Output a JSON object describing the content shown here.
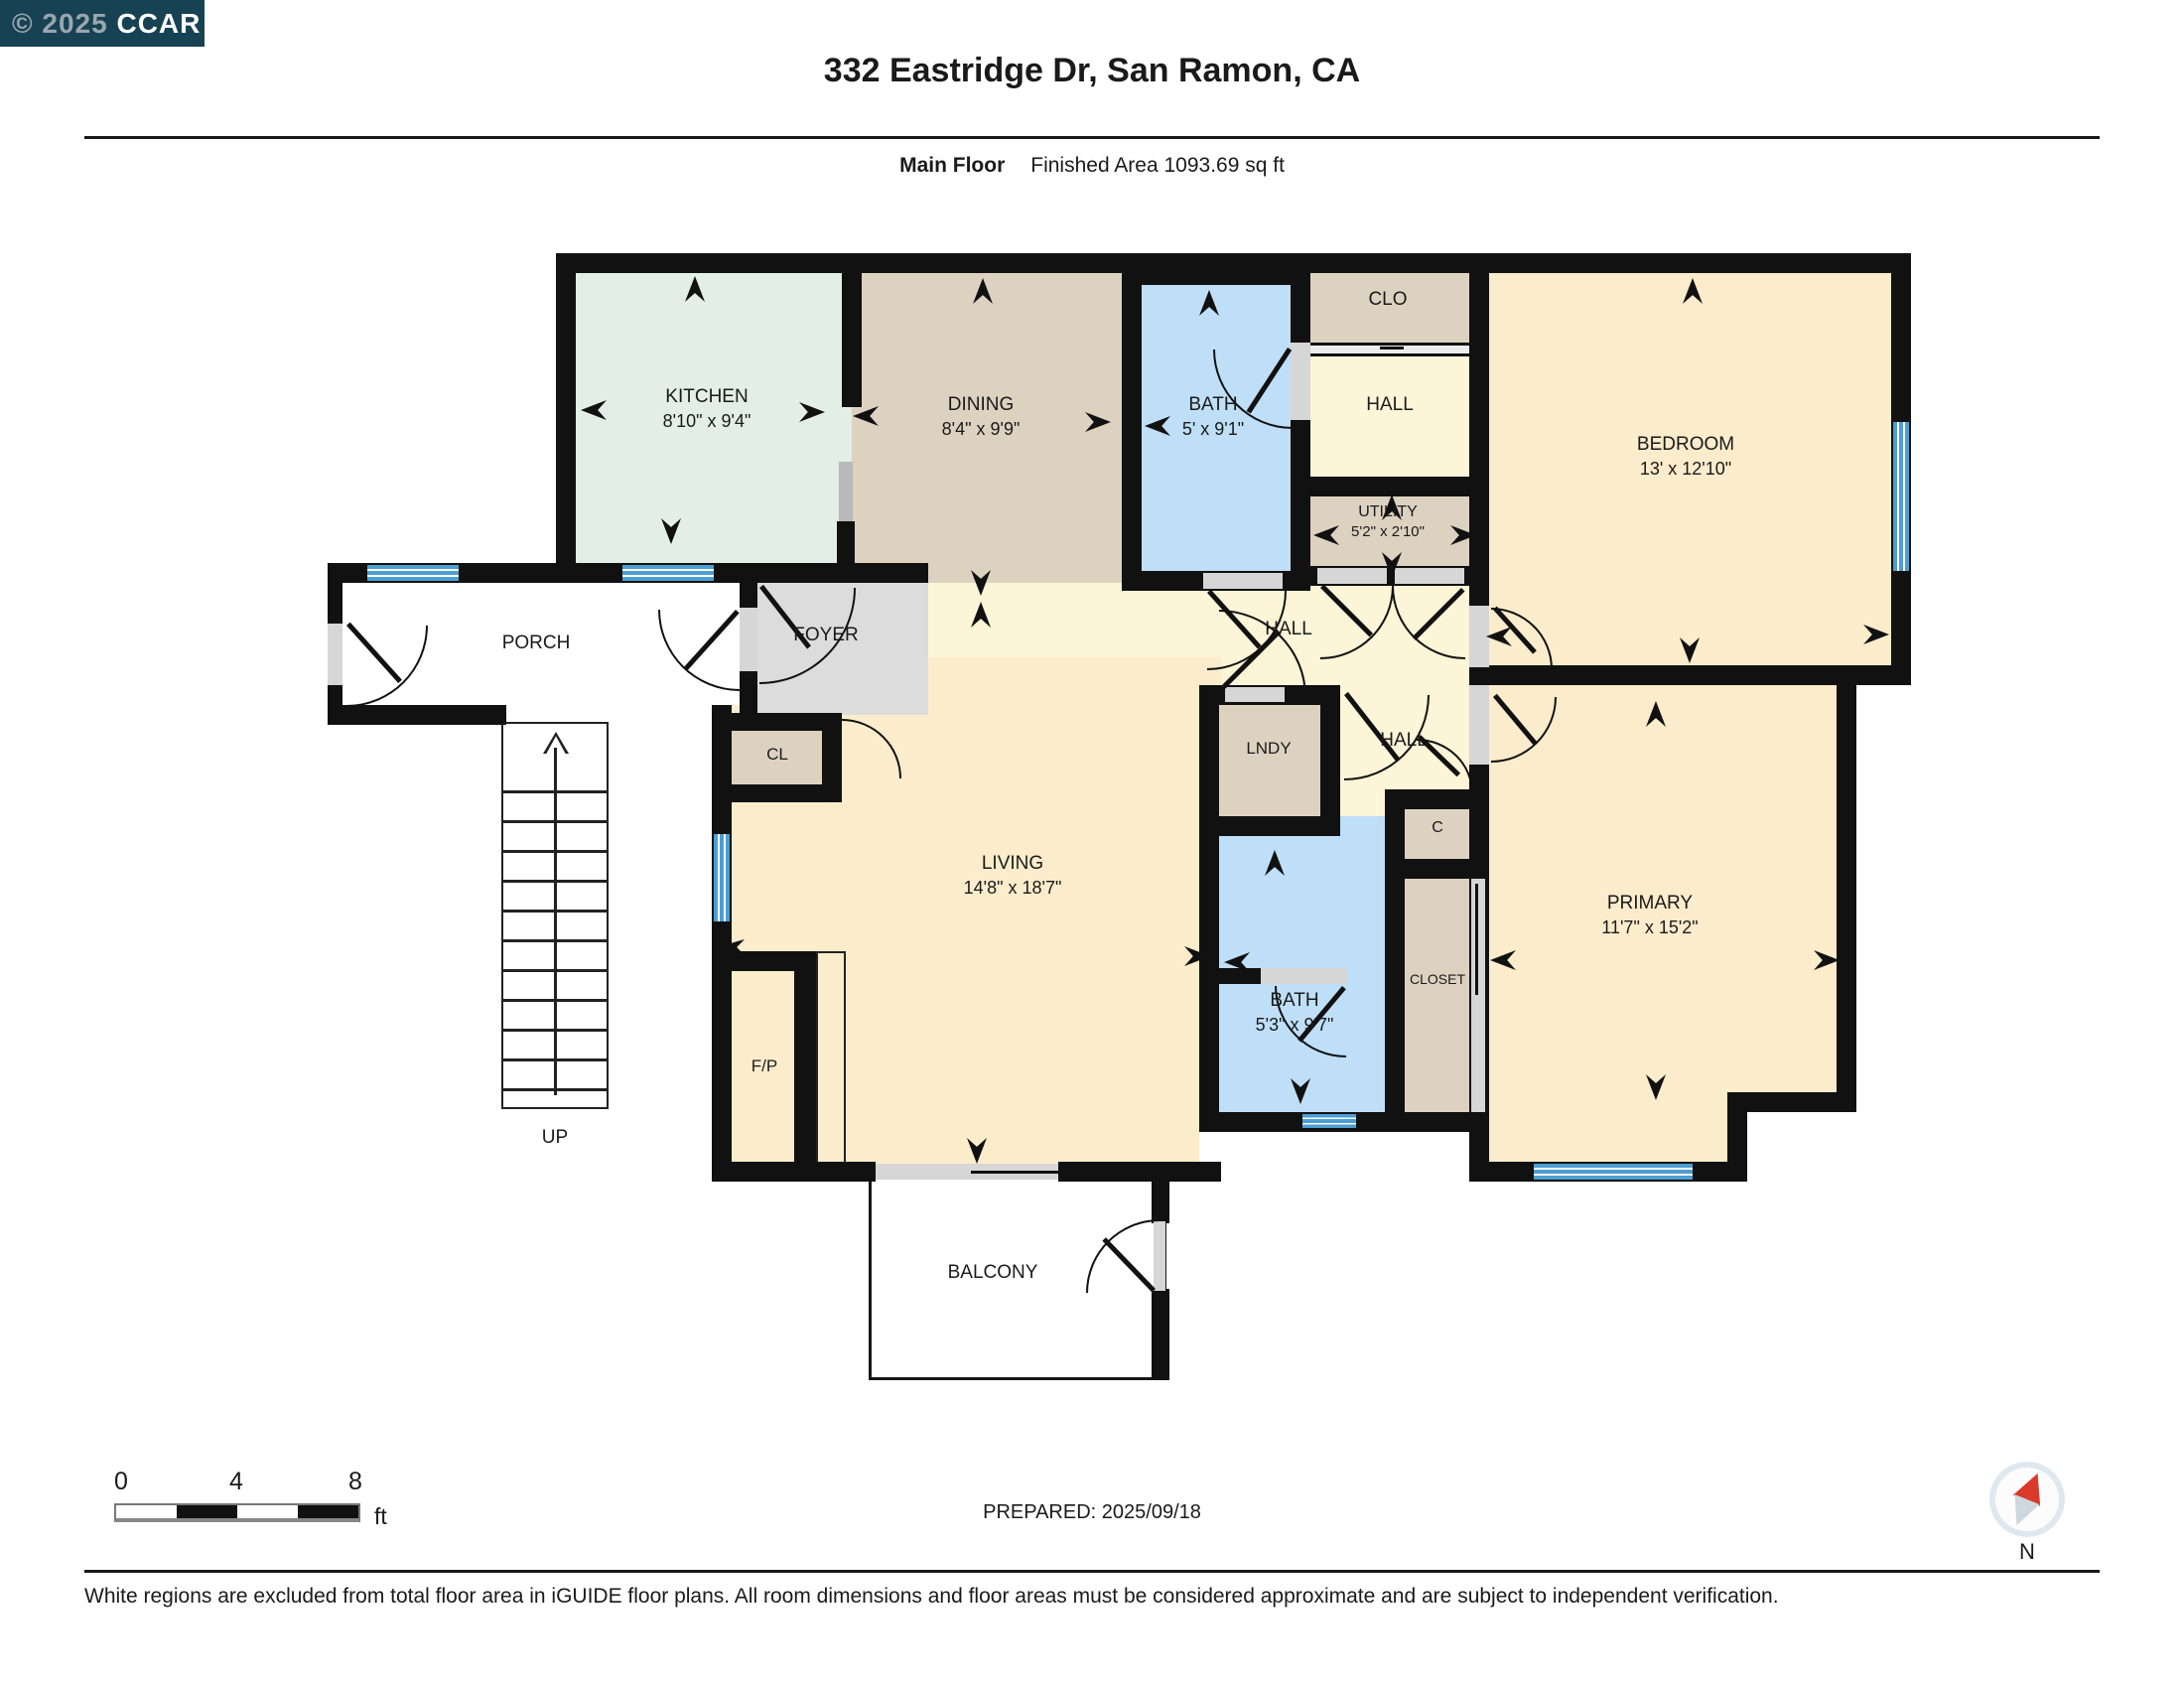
{
  "badge": {
    "copyright": "© 2025",
    "org": "CCAR"
  },
  "header": {
    "title": "332 Eastridge Dr, San Ramon, CA",
    "floor_label": "Main Floor",
    "area_label": "Finished Area 1093.69 sq ft"
  },
  "plan": {
    "rooms": {
      "kitchen": {
        "name": "KITCHEN",
        "dims": "8'10\" x 9'4\""
      },
      "dining": {
        "name": "DINING",
        "dims": "8'4\" x 9'9\""
      },
      "bath": {
        "name": "BATH",
        "dims": "5' x 9'1\""
      },
      "clo": {
        "name": "CLO"
      },
      "hall_upper": {
        "name": "HALL"
      },
      "bedroom": {
        "name": "BEDROOM",
        "dims": "13' x 12'10\""
      },
      "utility": {
        "name": "UTILITY",
        "dims": "5'2\" x 2'10\""
      },
      "hall_mid": {
        "name": "HALL"
      },
      "porch": {
        "name": "PORCH"
      },
      "foyer": {
        "name": "FOYER"
      },
      "cl": {
        "name": "CL"
      },
      "living": {
        "name": "LIVING",
        "dims": "14'8\" x 18'7\""
      },
      "lndy": {
        "name": "LNDY"
      },
      "hall_lower": {
        "name": "HALL"
      },
      "c": {
        "name": "C"
      },
      "closet": {
        "name": "CLOSET"
      },
      "bath2": {
        "name": "BATH",
        "dims": "5'3\" x 9'7\""
      },
      "primary": {
        "name": "PRIMARY",
        "dims": "11'7\" x 15'2\""
      },
      "fireplace": {
        "name": "F/P"
      },
      "balcony": {
        "name": "BALCONY"
      },
      "stairs": {
        "name": "UP"
      }
    }
  },
  "footer": {
    "scale": {
      "ticks": [
        "0",
        "4",
        "8"
      ],
      "unit": "ft"
    },
    "prepared": "PREPARED: 2025/09/18",
    "compass_label": "N",
    "disclaimer": "White regions are excluded from total floor area in iGUIDE floor plans. All room dimensions and floor areas must be considered approximate and are subject to independent verification."
  },
  "colors": {
    "wall": "#111111",
    "kitchen": "#e2eee6",
    "tan": "#ddd2c0",
    "hall_cream": "#fdf5d7",
    "room_cream": "#fbeccb",
    "bath_blue": "#bedff7",
    "window_blue": "#4d9ed2",
    "foyer_gray": "#dcdcdc",
    "badge_bg": "#174254"
  }
}
